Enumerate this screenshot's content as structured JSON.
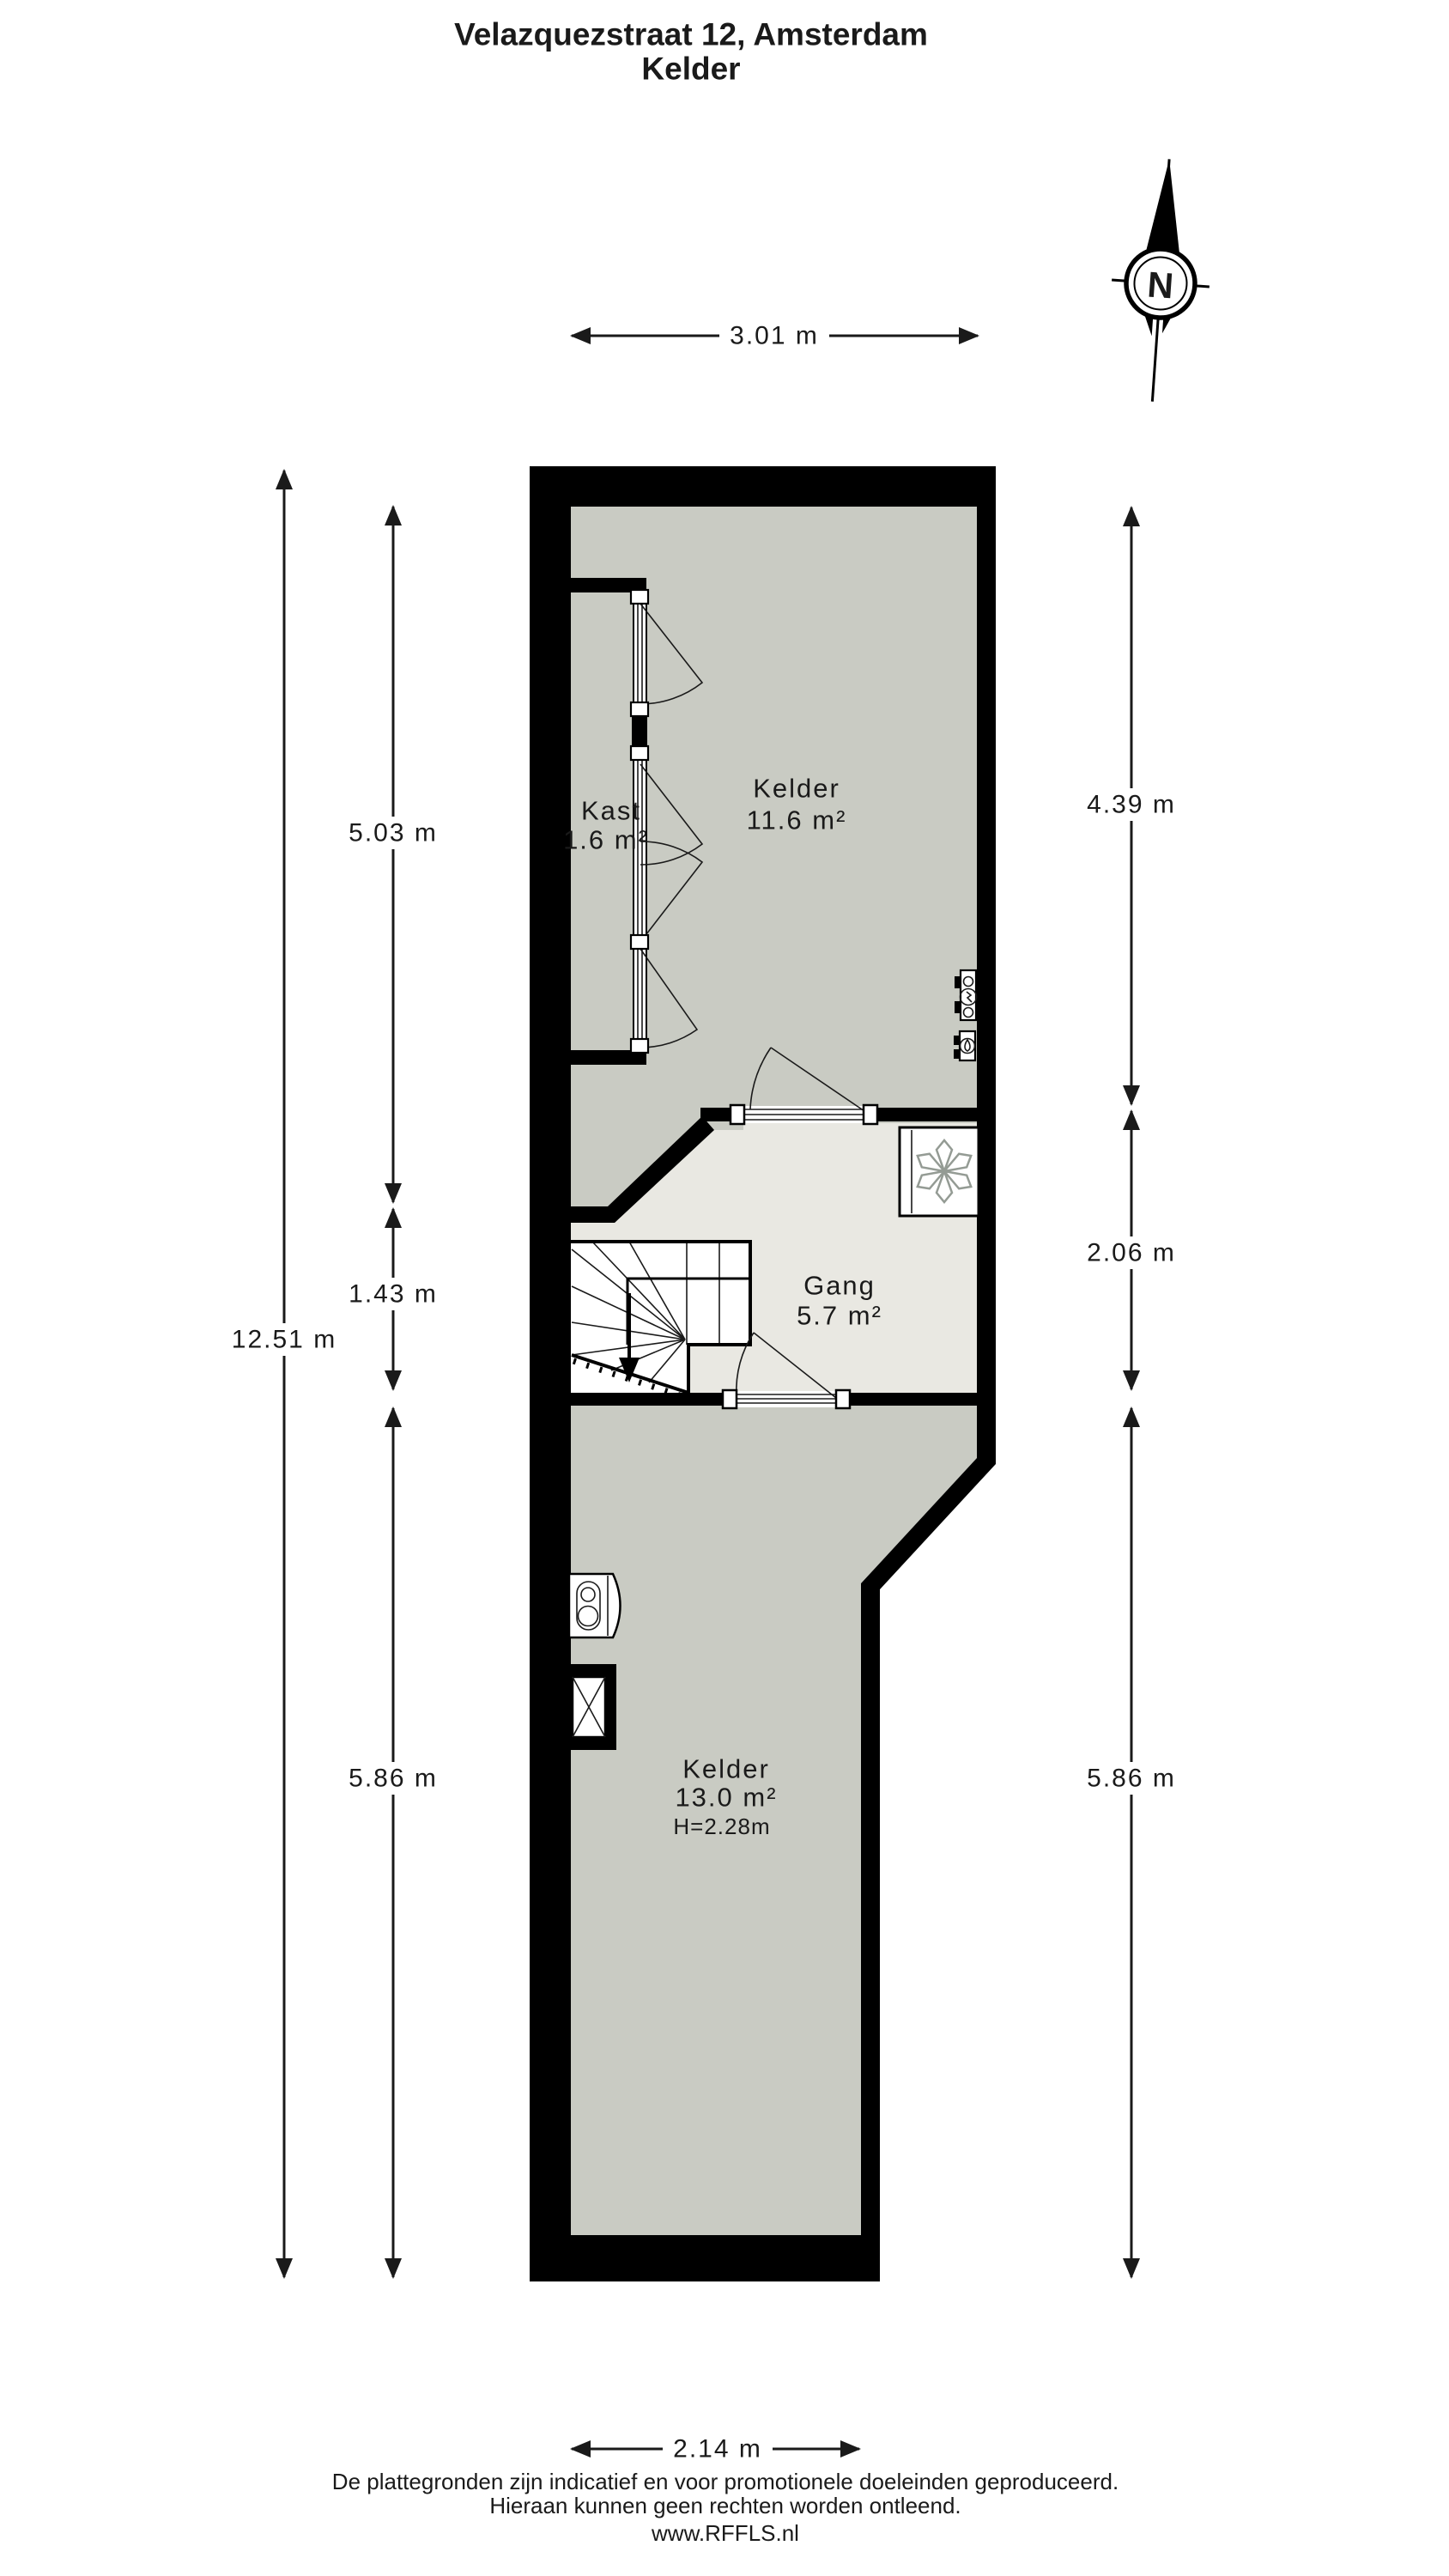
{
  "title": {
    "line1": "Velazquezstraat 12, Amsterdam",
    "line2": "Kelder"
  },
  "compass": {
    "label": "N"
  },
  "rooms": {
    "kelder_top": {
      "name": "Kelder",
      "area": "11.6 m²"
    },
    "kast": {
      "name": "Kast",
      "area": "1.6 m²"
    },
    "gang": {
      "name": "Gang",
      "area": "5.7 m²"
    },
    "kelder_bottom": {
      "name": "Kelder",
      "area": "13.0 m²",
      "height": "H=2.28m"
    }
  },
  "dimensions": {
    "top": "3.01 m",
    "bottom": "2.14 m",
    "left_total": "12.51 m",
    "left_top": "5.03 m",
    "left_mid": "1.43 m",
    "left_bottom": "5.86 m",
    "right_top": "4.39 m",
    "right_mid": "2.06 m",
    "right_bottom": "5.86 m"
  },
  "footer": {
    "line1": "De plattegronden zijn indicatief en voor promotionele doeleinden geproduceerd.",
    "line2": "Hieraan kunnen geen rechten worden ontleend.",
    "line3": "www.RFFLS.nl"
  },
  "colors": {
    "wall": "#000000",
    "floor_room": "#c9cbc3",
    "floor_hall": "#e9e8e2",
    "text": "#1a1a1a",
    "icon_gray": "#949b94"
  }
}
